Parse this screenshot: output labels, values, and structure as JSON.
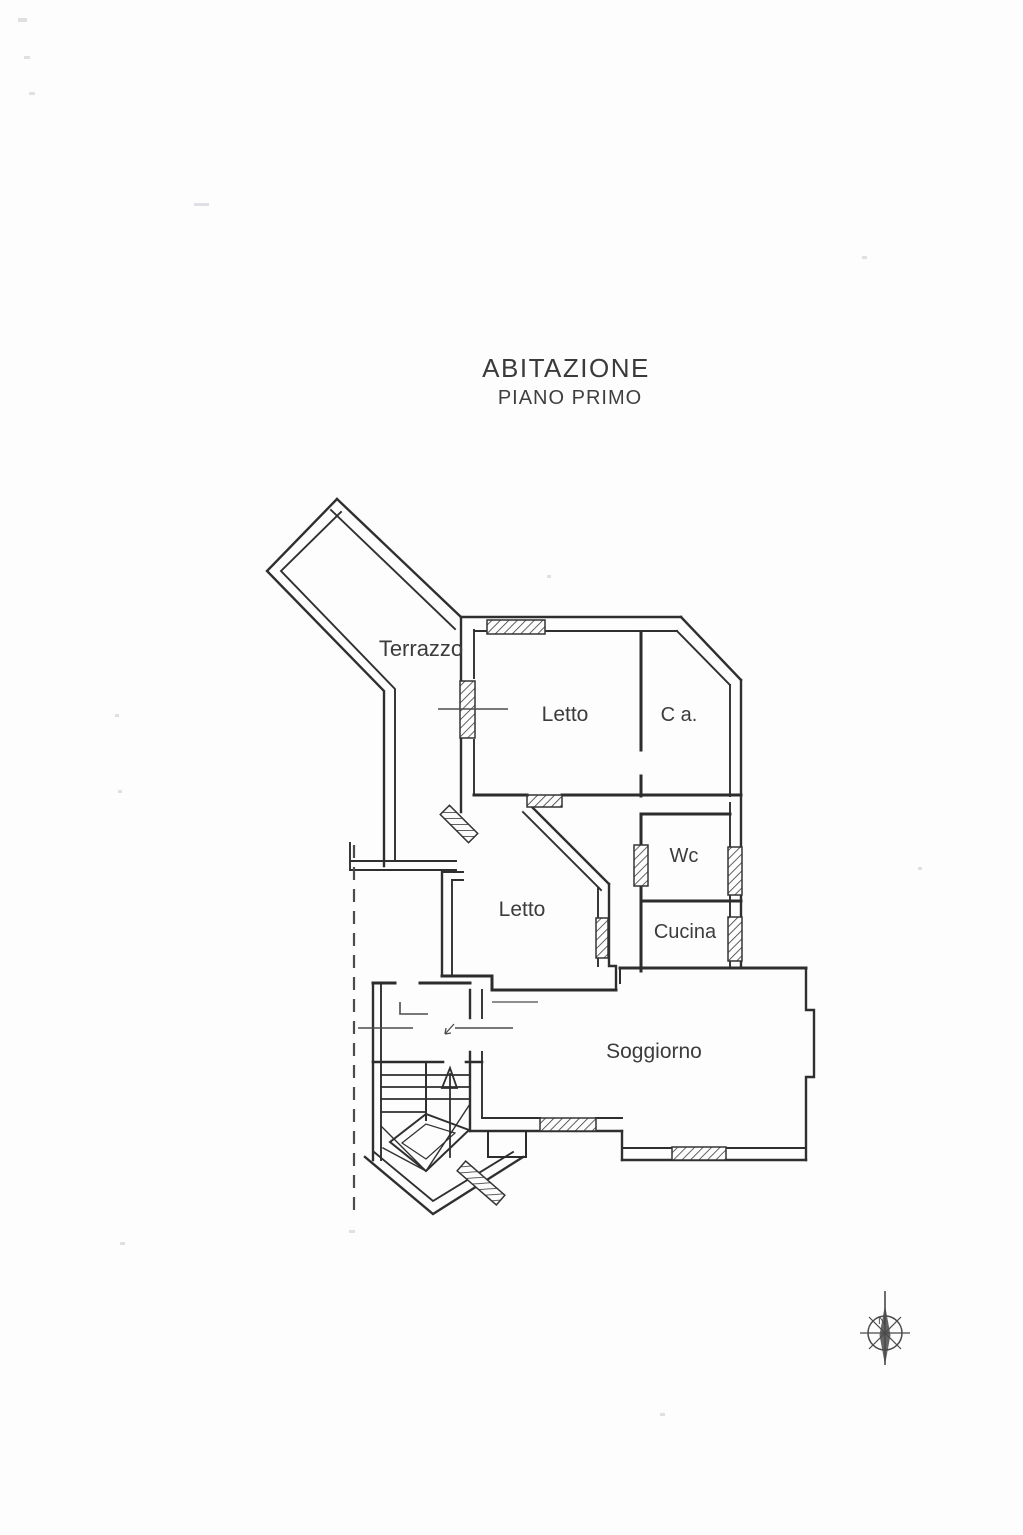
{
  "document": {
    "title": "ABITAZIONE",
    "subtitle": "PIANO PRIMO",
    "type_note": "scanned floor plan drawing"
  },
  "rooms": [
    {
      "label": "Terrazzo"
    },
    {
      "label": "Letto"
    },
    {
      "label": "C a."
    },
    {
      "label": "Wc"
    },
    {
      "label": "Cucina"
    },
    {
      "label": "Letto"
    },
    {
      "label": "Soggiorno"
    }
  ],
  "compass": {
    "north_label": "N"
  },
  "colors": {
    "paper": "#fdfdfe",
    "ink": "#2f2f2f",
    "light_ink": "#555555"
  }
}
